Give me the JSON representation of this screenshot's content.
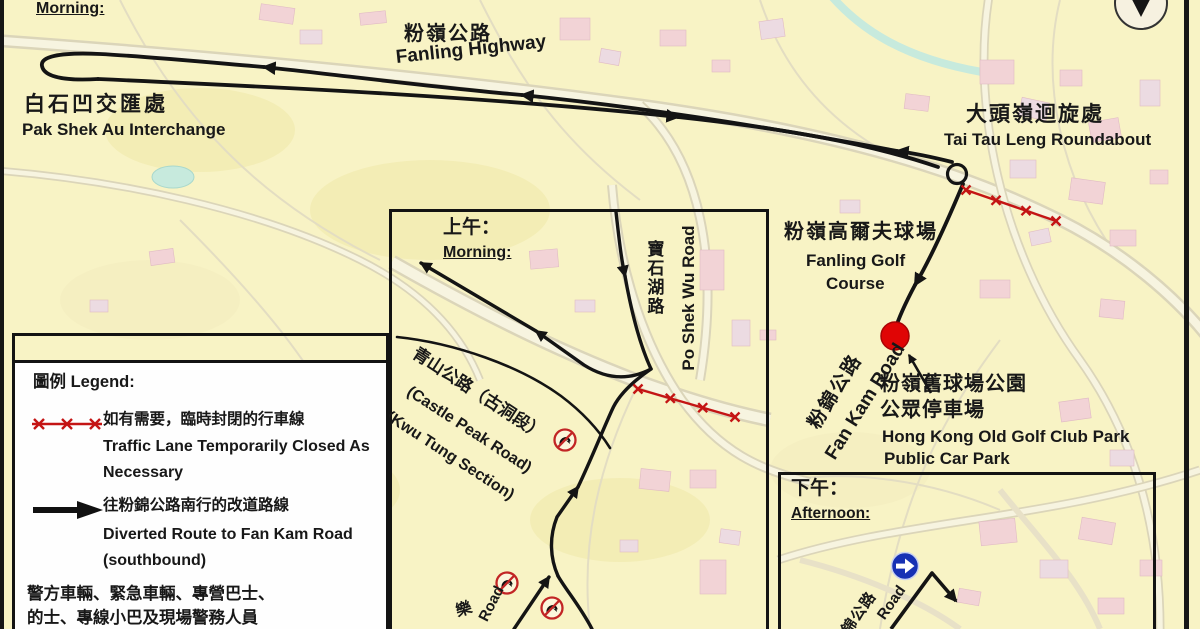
{
  "colors": {
    "map_bg": "#f8f3c5",
    "building_pink": "#f0c9dc",
    "building_purple": "#e9d4ec",
    "water_cyan": "#b7e7e6",
    "route_black": "#141414",
    "closure_red": "#c41414",
    "car_park_marker_red": "#e00505",
    "mandatory_sign_blue": "#1731b4",
    "legend_bg": "#fefefe"
  },
  "main_map": {
    "morning_label": "Morning:",
    "fanling_highway": {
      "zh": "粉嶺公路",
      "en": "Fanling Highway"
    },
    "pak_shek_au_interchange": {
      "zh": "白石凹交匯處",
      "en": "Pak Shek Au Interchange"
    },
    "tai_tau_leng_roundabout": {
      "zh": "大頭嶺迴旋處",
      "en": "Tai Tau Leng Roundabout"
    },
    "fanling_golf_course": {
      "zh": "粉嶺高爾夫球場",
      "en1": "Fanling Golf",
      "en2": "Course"
    },
    "fan_kam_road": {
      "zh": "粉錦公路",
      "en": "Fan Kam Road"
    },
    "car_park": {
      "zh1": "粉嶺舊球場公園",
      "zh2": "公眾停車場",
      "en1": "Hong Kong Old Golf Club Park",
      "en2": "Public Car Park"
    }
  },
  "inset_map": {
    "title": {
      "zh": "上午：",
      "en": "Morning:"
    },
    "po_shek_wu_road": {
      "zh": "寶石湖路",
      "en": "Po Shek Wu Road"
    },
    "castle_peak_road": {
      "zh": "青山公路（古洞段）",
      "en1": "(Castle Peak Road)",
      "en2": "(Kwu Tung Section)"
    },
    "road_fragment": {
      "zh": "樂",
      "en": "Road"
    }
  },
  "afternoon_map": {
    "title": {
      "zh": "下午：",
      "en": "Afternoon:"
    },
    "fan_kam_road_fragment": {
      "zh": "粉錦公路",
      "en": "Road"
    }
  },
  "legend": {
    "title": "圖例 Legend:",
    "items": [
      {
        "symbol": "red-x-closed-lane",
        "zh": "如有需要，臨時封閉的行車線",
        "en1": "Traffic Lane Temporarily Closed As",
        "en2": "Necessary"
      },
      {
        "symbol": "black-diversion-arrow",
        "zh": "往粉錦公路南行的改道路線",
        "en1": "Diverted Route to Fan Kam Road",
        "en2": "(southbound)"
      }
    ],
    "footer1": "警方車輛、緊急車輛、專營巴士、",
    "footer2": "的士、專線小巴及現場警務人員"
  }
}
